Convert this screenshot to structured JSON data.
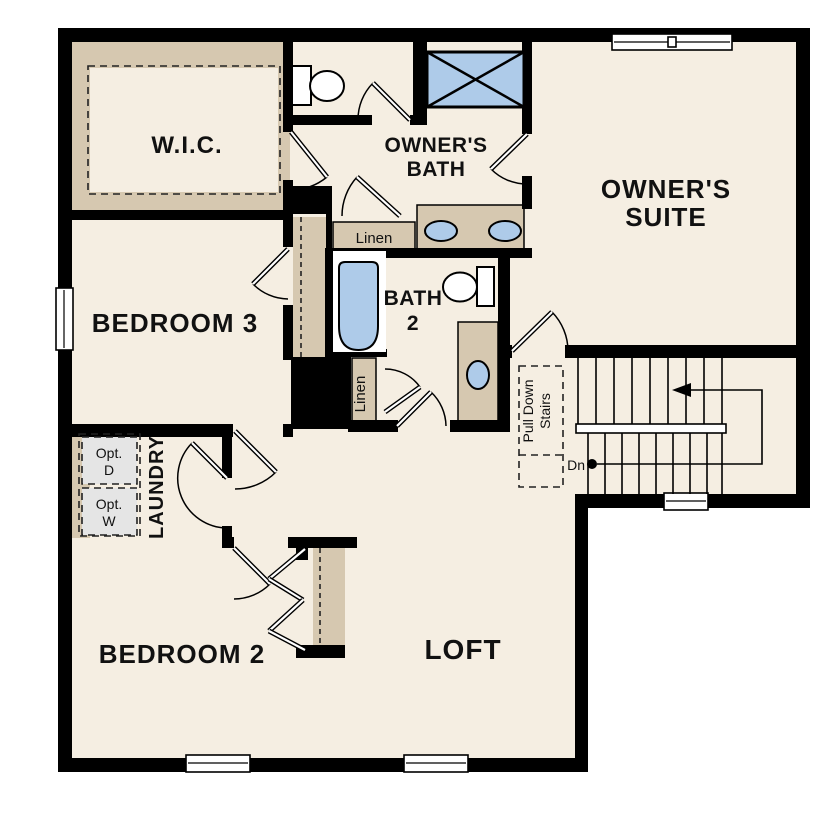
{
  "rooms": {
    "wic": {
      "label": "W.I.C."
    },
    "owners_bath": {
      "label_line1": "OWNER'S",
      "label_line2": "BATH"
    },
    "owners_suite": {
      "label_line1": "OWNER'S",
      "label_line2": "SUITE"
    },
    "bedroom3": {
      "label": "BEDROOM 3"
    },
    "bath2": {
      "label_line1": "BATH",
      "label_line2": "2"
    },
    "laundry": {
      "label": "LAUNDRY"
    },
    "bedroom2": {
      "label": "BEDROOM 2"
    },
    "loft": {
      "label": "LOFT"
    }
  },
  "closets": {
    "linen_bath_hall": "Linen",
    "linen_bath2": "Linen"
  },
  "stairs": {
    "down_label": "Dn",
    "pull_down_line1": "Pull Down",
    "pull_down_line2": "Stairs"
  },
  "appliances": {
    "opt_dryer_line1": "Opt.",
    "opt_dryer_line2": "D",
    "opt_washer_line1": "Opt.",
    "opt_washer_line2": "W"
  },
  "colors": {
    "background": "#ffffff",
    "floor": "#f5eee2",
    "wall": "#000000",
    "casework_tan": "#d6c8b0",
    "fixture_blue": "#aecbe9",
    "option_gray": "#e5e5e5"
  }
}
